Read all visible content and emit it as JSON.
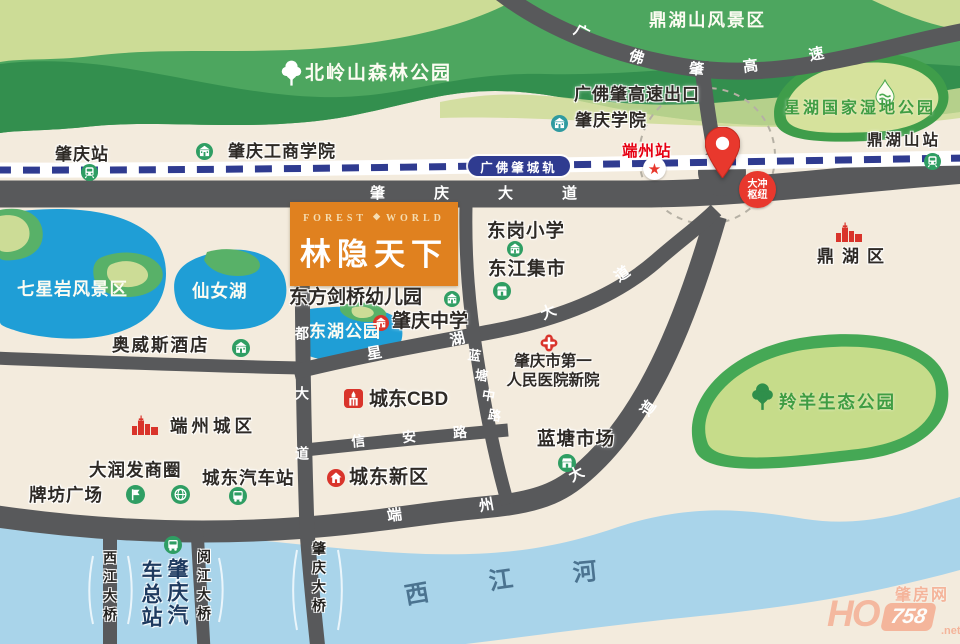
{
  "project": {
    "name_cn": "林隐天下",
    "name_en_left": "FOREST",
    "name_en_right": "WORLD",
    "ornament": "◆"
  },
  "railway": {
    "label": "广佛肇城轨"
  },
  "roads": {
    "zhaoqing_dadao": {
      "label": "肇庆大道"
    },
    "yandu_dadao": {
      "label": "砚都大道"
    },
    "xinan_lu": {
      "label": "信安路"
    },
    "xinghu_dadao": {
      "chars": [
        "星",
        "湖",
        "大",
        "道"
      ]
    },
    "lantang_zhonglu": {
      "chars": [
        "蓝",
        "塘",
        "中",
        "路"
      ]
    },
    "duanzhou_dadao": {
      "chars": [
        "端",
        "州",
        "大",
        "道"
      ]
    },
    "gfz_expressway": {
      "chars": [
        "广",
        "佛",
        "肇",
        "高",
        "速"
      ]
    },
    "xijiang_river": {
      "chars": [
        "西",
        "江",
        "河"
      ]
    },
    "xijiang_bridge": {
      "label": "西江大桥"
    },
    "yuejiang_bridge": {
      "label": "阅江大桥"
    },
    "zhaoqing_bridge": {
      "label": "肇庆大桥"
    }
  },
  "stations": {
    "zhaoqing": "肇庆站",
    "duanzhou": "端州站",
    "dinghushan": "鼎湖山站",
    "dachong": {
      "line1": "大冲",
      "line2": "枢纽"
    }
  },
  "landmarks": {
    "beiling": "北岭山森林公园",
    "dinghushan_scenic": "鼎湖山风景区",
    "expressway_exit": "广佛肇高速出口",
    "zhaoqing_college": "肇庆学院",
    "gongshang_college": "肇庆工商学院",
    "xinghu_wetland": "星湖国家湿地公园",
    "dinghu_district": "鼎湖区",
    "donggang_primary": "东岗小学",
    "dongjiang_market": "东江集市",
    "kindergarten": "东方剑桥幼儿园",
    "zhaoqing_middle": "肇庆中学",
    "donghu_park": "东湖公园",
    "qixingyan": "七星岩风景区",
    "xiannvhu": "仙女湖",
    "aowisi_hotel": "奥威斯酒店",
    "hospital_line1": "肇庆市第一",
    "hospital_line2": "人民医院新院",
    "chengdong_cbd": "城东CBD",
    "lantang_market": "蓝塘市场",
    "lingyang_park": "羚羊生态公园",
    "duanzhou_city": "端州城区",
    "darunfa": "大润发商圈",
    "paifang": "牌坊广场",
    "chengdong_bus": "城东汽车站",
    "chengdong_new": "城东新区",
    "qiche_col1": "肇庆汽",
    "qiche_col2": "车总站"
  },
  "watermark": {
    "site": "肇房网",
    "ho": "HO",
    "num": "758",
    "tld": ".net"
  },
  "colors": {
    "background": "#f3ebdd",
    "road": "#58595b",
    "railway_dash": "#2f3b90",
    "brand_orange": "#e0811f",
    "marker_red": "#e8382d",
    "station_red": "#e60012",
    "icon_green": "#2f9e63",
    "icon_teal": "#2f9aa0",
    "park_green": "#4da65f",
    "park_dark": "#338f4e",
    "park_pale": "#ccdc96",
    "lake_blue": "#1f9ed6",
    "river_blue": "#a9d4ea",
    "wetland_fill": "#d6e29c",
    "green_label": "#3f9d43",
    "watermark_salmon": "#f4a88c"
  }
}
